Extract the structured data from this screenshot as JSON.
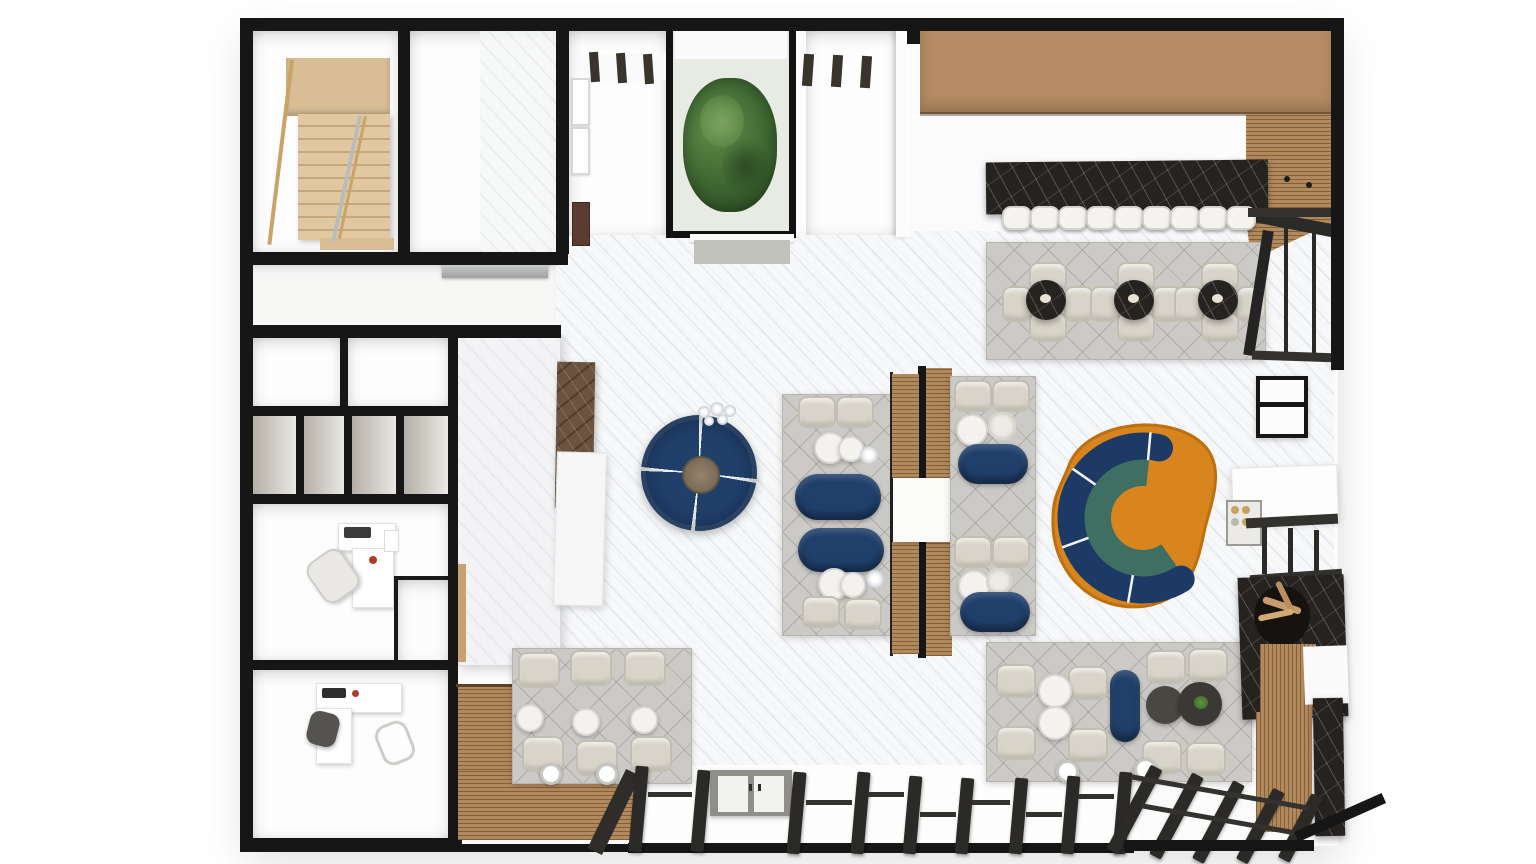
{
  "meta": {
    "title": "Top-down 3D rendered floor plan of a hospitality interior with bar, lounge seating, offices and terraces",
    "canvas_width": 1536,
    "canvas_height": 864,
    "view": "top-down orthographic 3D render",
    "visible_text": "none"
  },
  "palette": {
    "background": "#ffffff",
    "walls": "#161616",
    "marble_floor": "#f7f8f9",
    "rug_gray": "#cccac6",
    "tan_counter_top": "#b48b62",
    "deck_wood": "#b2895c",
    "navy_upholstery": "#20406c",
    "orange_rug": "#d9851e",
    "teal_accent": "#3e6f62",
    "gray_band": "#bab6af",
    "beige_chair": "#d9d4c9",
    "dark_marble": "#262220",
    "brown_marble_panel": "#6b5340",
    "stair_wood": "#d8bd95",
    "plant_green": "#4a7a3c",
    "white_furniture": "#f3f2ef"
  },
  "rooms": [
    {
      "id": "staircase-room",
      "area": "top-left",
      "contents": "wooden staircase with landing and handrails"
    },
    {
      "id": "vacant-room",
      "area": "top-left",
      "contents": "empty room, marble walls"
    },
    {
      "id": "gallery-room",
      "area": "top-center-left",
      "contents": "wall frames, dark artwork, striped ceiling beams"
    },
    {
      "id": "atrium-planter",
      "area": "top-center",
      "contents": "glazed courtyard with large green plant"
    },
    {
      "id": "entry-vestibule",
      "area": "top-center-right",
      "contents": "striped ceiling beams"
    },
    {
      "id": "corridor",
      "area": "left",
      "contents": "extractor vent on wall"
    },
    {
      "id": "meeting-room-a",
      "area": "left",
      "contents": "empty"
    },
    {
      "id": "meeting-room-b",
      "area": "left",
      "contents": "empty"
    },
    {
      "id": "storage-cubbies",
      "area": "left",
      "compartments": 4
    },
    {
      "id": "office-1",
      "area": "left",
      "contents": "white L-desk, monitor, task chair"
    },
    {
      "id": "office-2",
      "area": "lower-left",
      "contents": "white L-desk, keyboard, dark task chair, guest chair"
    },
    {
      "id": "closet-nook",
      "area": "left",
      "contents": "empty"
    },
    {
      "id": "service-core",
      "area": "center-left",
      "contents": "marble volume with brown marble panel and white counter"
    },
    {
      "id": "main-hall",
      "area": "center",
      "contents": "white marble floor, lounge and dining clusters"
    },
    {
      "id": "bar-zone",
      "area": "top-right",
      "contents": "black marble bar counter, 9 stools, tan back counter"
    },
    {
      "id": "terrace-sw",
      "area": "bottom-left",
      "contents": "wood deck, 6 chairs, 3 tables, 2 floor lamps"
    },
    {
      "id": "porch-south",
      "area": "bottom-center",
      "contents": "pergola posts, double door, glazing rails"
    },
    {
      "id": "veranda-se",
      "area": "bottom-right",
      "contents": "diagonal pergola joists, rattan panel, black marble chimney"
    }
  ],
  "furniture": {
    "bar": {
      "counter_material": "black marble",
      "stool_count": 9,
      "stool_color": "white",
      "back_counter_color": "tan"
    },
    "marble_dining_ne": {
      "tables": 3,
      "table_top": "black marble",
      "chairs_per_table": 4,
      "chair_color": "beige",
      "rug": "gray diamond-weave"
    },
    "round_sofa": {
      "type": "circular modular sofa, 4 segments",
      "color": "navy",
      "center_table": "walnut round",
      "chandelier": "glass bubble cluster"
    },
    "booth-row-1": {
      "armchairs": 4,
      "navy_loveseats": 2,
      "white_side_tables": 4,
      "glass_side_lamps": 2,
      "rug": "gray"
    },
    "booth-row-2": {
      "groups": 2,
      "armchairs": 4,
      "navy_loveseats": 2,
      "white_tables": 2,
      "floral_centerpieces": 2,
      "rug": "gray"
    },
    "booth-divider": {
      "type": "double-sided wood-slat screen with white pass-through counter"
    },
    "curved_sofa": {
      "shape": "C-shaped sectional opening right",
      "color": "navy",
      "rug": "orange organic",
      "inner_bands": [
        "gray",
        "teal"
      ]
    },
    "lounge_se": {
      "beige_chairs": 8,
      "white_tables": 2,
      "dark_coffee_tables": 2,
      "navy_bench": 1,
      "plant_on_table": true,
      "floor_lamps": 2
    },
    "terrace_sw": {
      "beige_chairs": 6,
      "white_tables": 3,
      "floor_lamps": 2,
      "deck": "ribbed wood L-shape"
    },
    "right_edge": {
      "service_counter": "white",
      "bottle_rack_bottles": 4,
      "high_table": "black frame",
      "railings": "black metal",
      "fireplace": "black marble with driftwood and rattan"
    },
    "porch": {
      "posts": 9,
      "double_door_panels": 2,
      "sill": "black",
      "se_joists": 5
    }
  }
}
